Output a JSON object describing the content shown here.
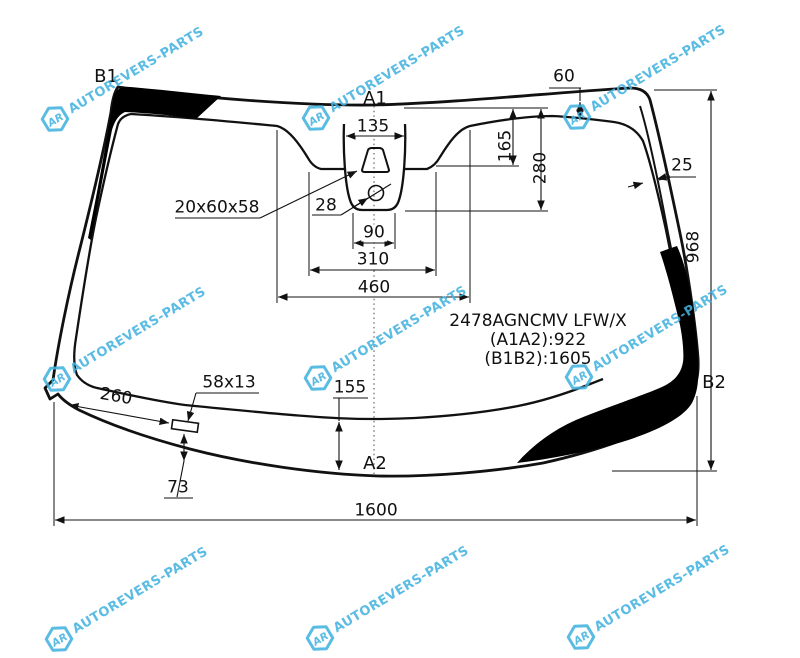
{
  "part": {
    "code": "2478AGNCMV LFW/X",
    "a1a2": "(A1A2):922",
    "b1b2": "(B1B2):1605"
  },
  "axes": {
    "a1": "A1",
    "a2": "A2",
    "b1": "B1",
    "b2": "B2"
  },
  "dims": {
    "total_width": "1600",
    "total_height": "968",
    "cutout_460": "460",
    "cutout_310": "310",
    "cutout_90": "90",
    "cutout_135": "135",
    "depth_165": "165",
    "depth_280": "280",
    "band_60": "60",
    "pillar_25": "25",
    "bottom_155": "155",
    "bottom_260": "260",
    "bottom_73": "73",
    "pad_58x13": "58x13",
    "bracket_20x60x58": "20x60x58",
    "sensor_28": "28"
  },
  "watermark": {
    "logo": "AR",
    "text": "AUTOREVERS-PARTS",
    "color": "#45b3e0"
  },
  "colors": {
    "line": "#111111",
    "frit_band": "#000000",
    "background": "#ffffff"
  }
}
